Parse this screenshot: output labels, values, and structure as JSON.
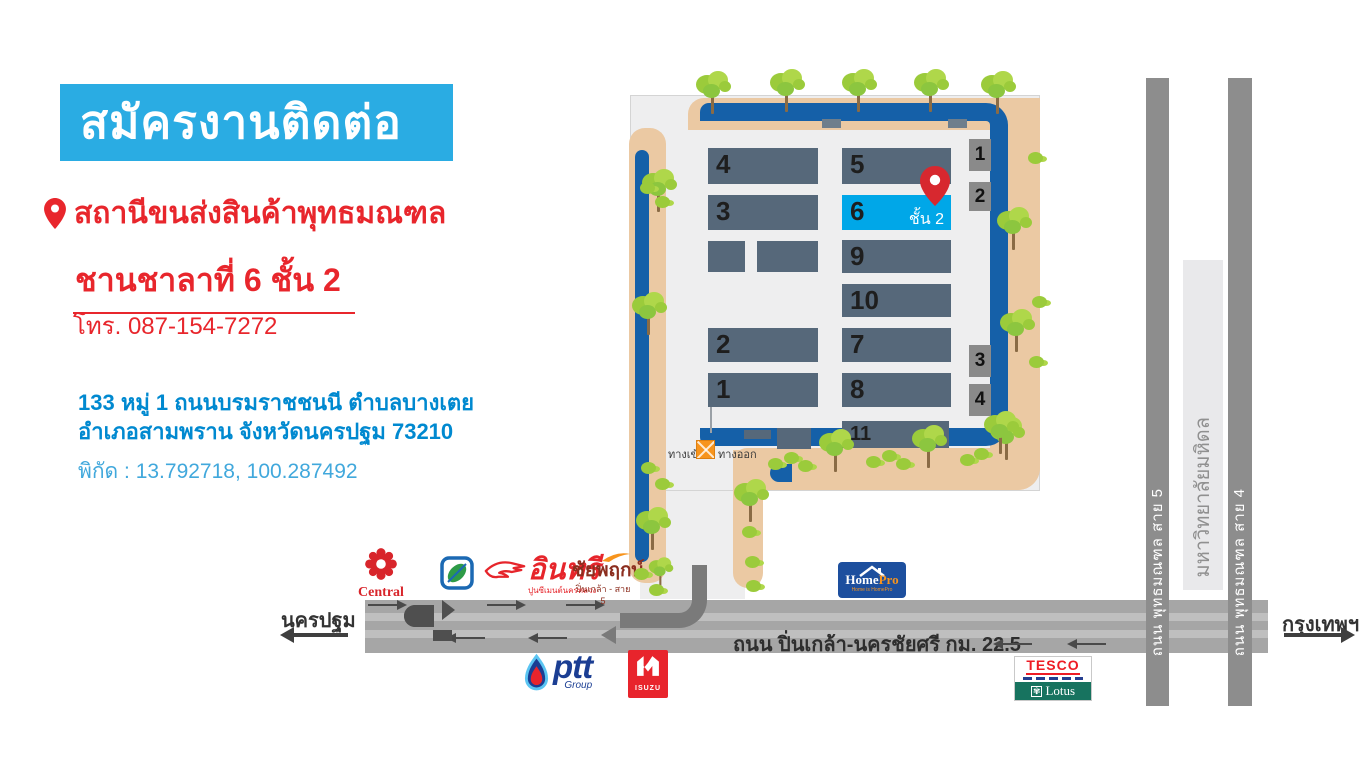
{
  "header": {
    "title": "สมัครงานติดต่อ"
  },
  "location": {
    "name": "สถานีขนส่งสินค้าพุทธมณฑล",
    "platform": "ชานชาลาที่ 6 ชั้น 2",
    "phone": "โทร. 087-154-7272",
    "address_line1": "133 หมู่ 1 ถนนบรมราชชนนี ตำบลบางเตย",
    "address_line2": "อำเภอสามพราน  จังหวัดนครปฐม  73210",
    "coordinates": "พิกัด : 13.792718, 100.287492"
  },
  "map": {
    "buildings": {
      "b1": "1",
      "b2": "2",
      "b3": "3",
      "b4": "4",
      "b5": "5",
      "b6": "6",
      "b7": "7",
      "b8": "8",
      "b9": "9",
      "b10": "10",
      "b11": "11"
    },
    "docks": {
      "d1": "1",
      "d2": "2",
      "d3": "3",
      "d4": "4"
    },
    "highlight_floor": "ชั้น 2",
    "entrance": "ทางเข้า",
    "exit": "ทางออก"
  },
  "roads": {
    "main": "ถนน ปิ่นเกล้า-นครชัยศรี กม. 22.5",
    "sai5": "ถนน พุทธมณฑล สาย 5",
    "sai4": "ถนน พุทธมณฑล สาย 4",
    "university": "มหาวิทยาลัยมหิดล",
    "west": "นครปฐม",
    "east": "กรุงเทพฯ"
  },
  "landmarks": {
    "central": "Central",
    "insee": "อินทรี",
    "insee_sub": "ปูนซีเมนต์นครหลวง",
    "chaiyapruek": "ชัยพฤกษ์",
    "chaiyapruek_sub": "ปิ่นเกล้า - สาย 5",
    "homepro_home": "Home",
    "homepro_pro": "Pro",
    "homepro_slogan": "Home is HomePro",
    "ptt": "ptt",
    "ptt_sub": "Group",
    "isuzu": "ISUZU",
    "tesco": "TESCO",
    "lotus": "Lotus"
  },
  "colors": {
    "banner_blue": "#2AACE3",
    "accent_red": "#E8262C",
    "address_blue": "#0089D0",
    "coords_blue": "#41A8DC",
    "highlight_blue": "#00A7E8",
    "map_road_blue": "#1560A8",
    "sidewalk_tan": "#EBC9A3",
    "building_gray": "#56687A"
  }
}
